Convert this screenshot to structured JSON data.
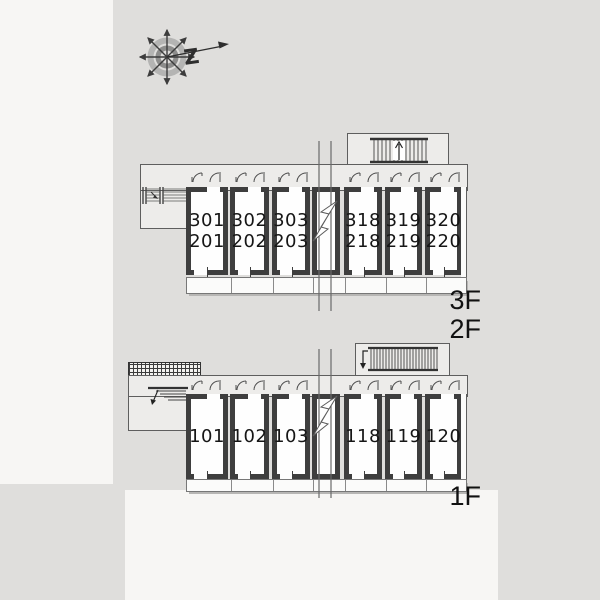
{
  "compass": {
    "letter": "Z"
  },
  "buildings": [
    {
      "name": "upper-building-floors-2-3",
      "floor_labels": [
        "3F",
        "2F"
      ],
      "rooms": [
        {
          "lines": [
            "301",
            "201"
          ]
        },
        {
          "lines": [
            "302",
            "202"
          ]
        },
        {
          "lines": [
            "303",
            "203"
          ]
        },
        {
          "lines": [
            "318",
            "218"
          ]
        },
        {
          "lines": [
            "319",
            "219"
          ]
        },
        {
          "lines": [
            "320",
            "220"
          ]
        }
      ]
    },
    {
      "name": "lower-building-floor-1",
      "floor_labels": [
        "1F"
      ],
      "rooms": [
        {
          "lines": [
            "101"
          ]
        },
        {
          "lines": [
            "102"
          ]
        },
        {
          "lines": [
            "103"
          ]
        },
        {
          "lines": [
            "118"
          ]
        },
        {
          "lines": [
            "119"
          ]
        },
        {
          "lines": [
            "120"
          ]
        }
      ]
    }
  ],
  "colors": {
    "background": "#dfdedc",
    "paper": "#f7f6f4",
    "corridor_fill": "#edecea",
    "wall": "#3e3e3e",
    "text": "#161616"
  }
}
